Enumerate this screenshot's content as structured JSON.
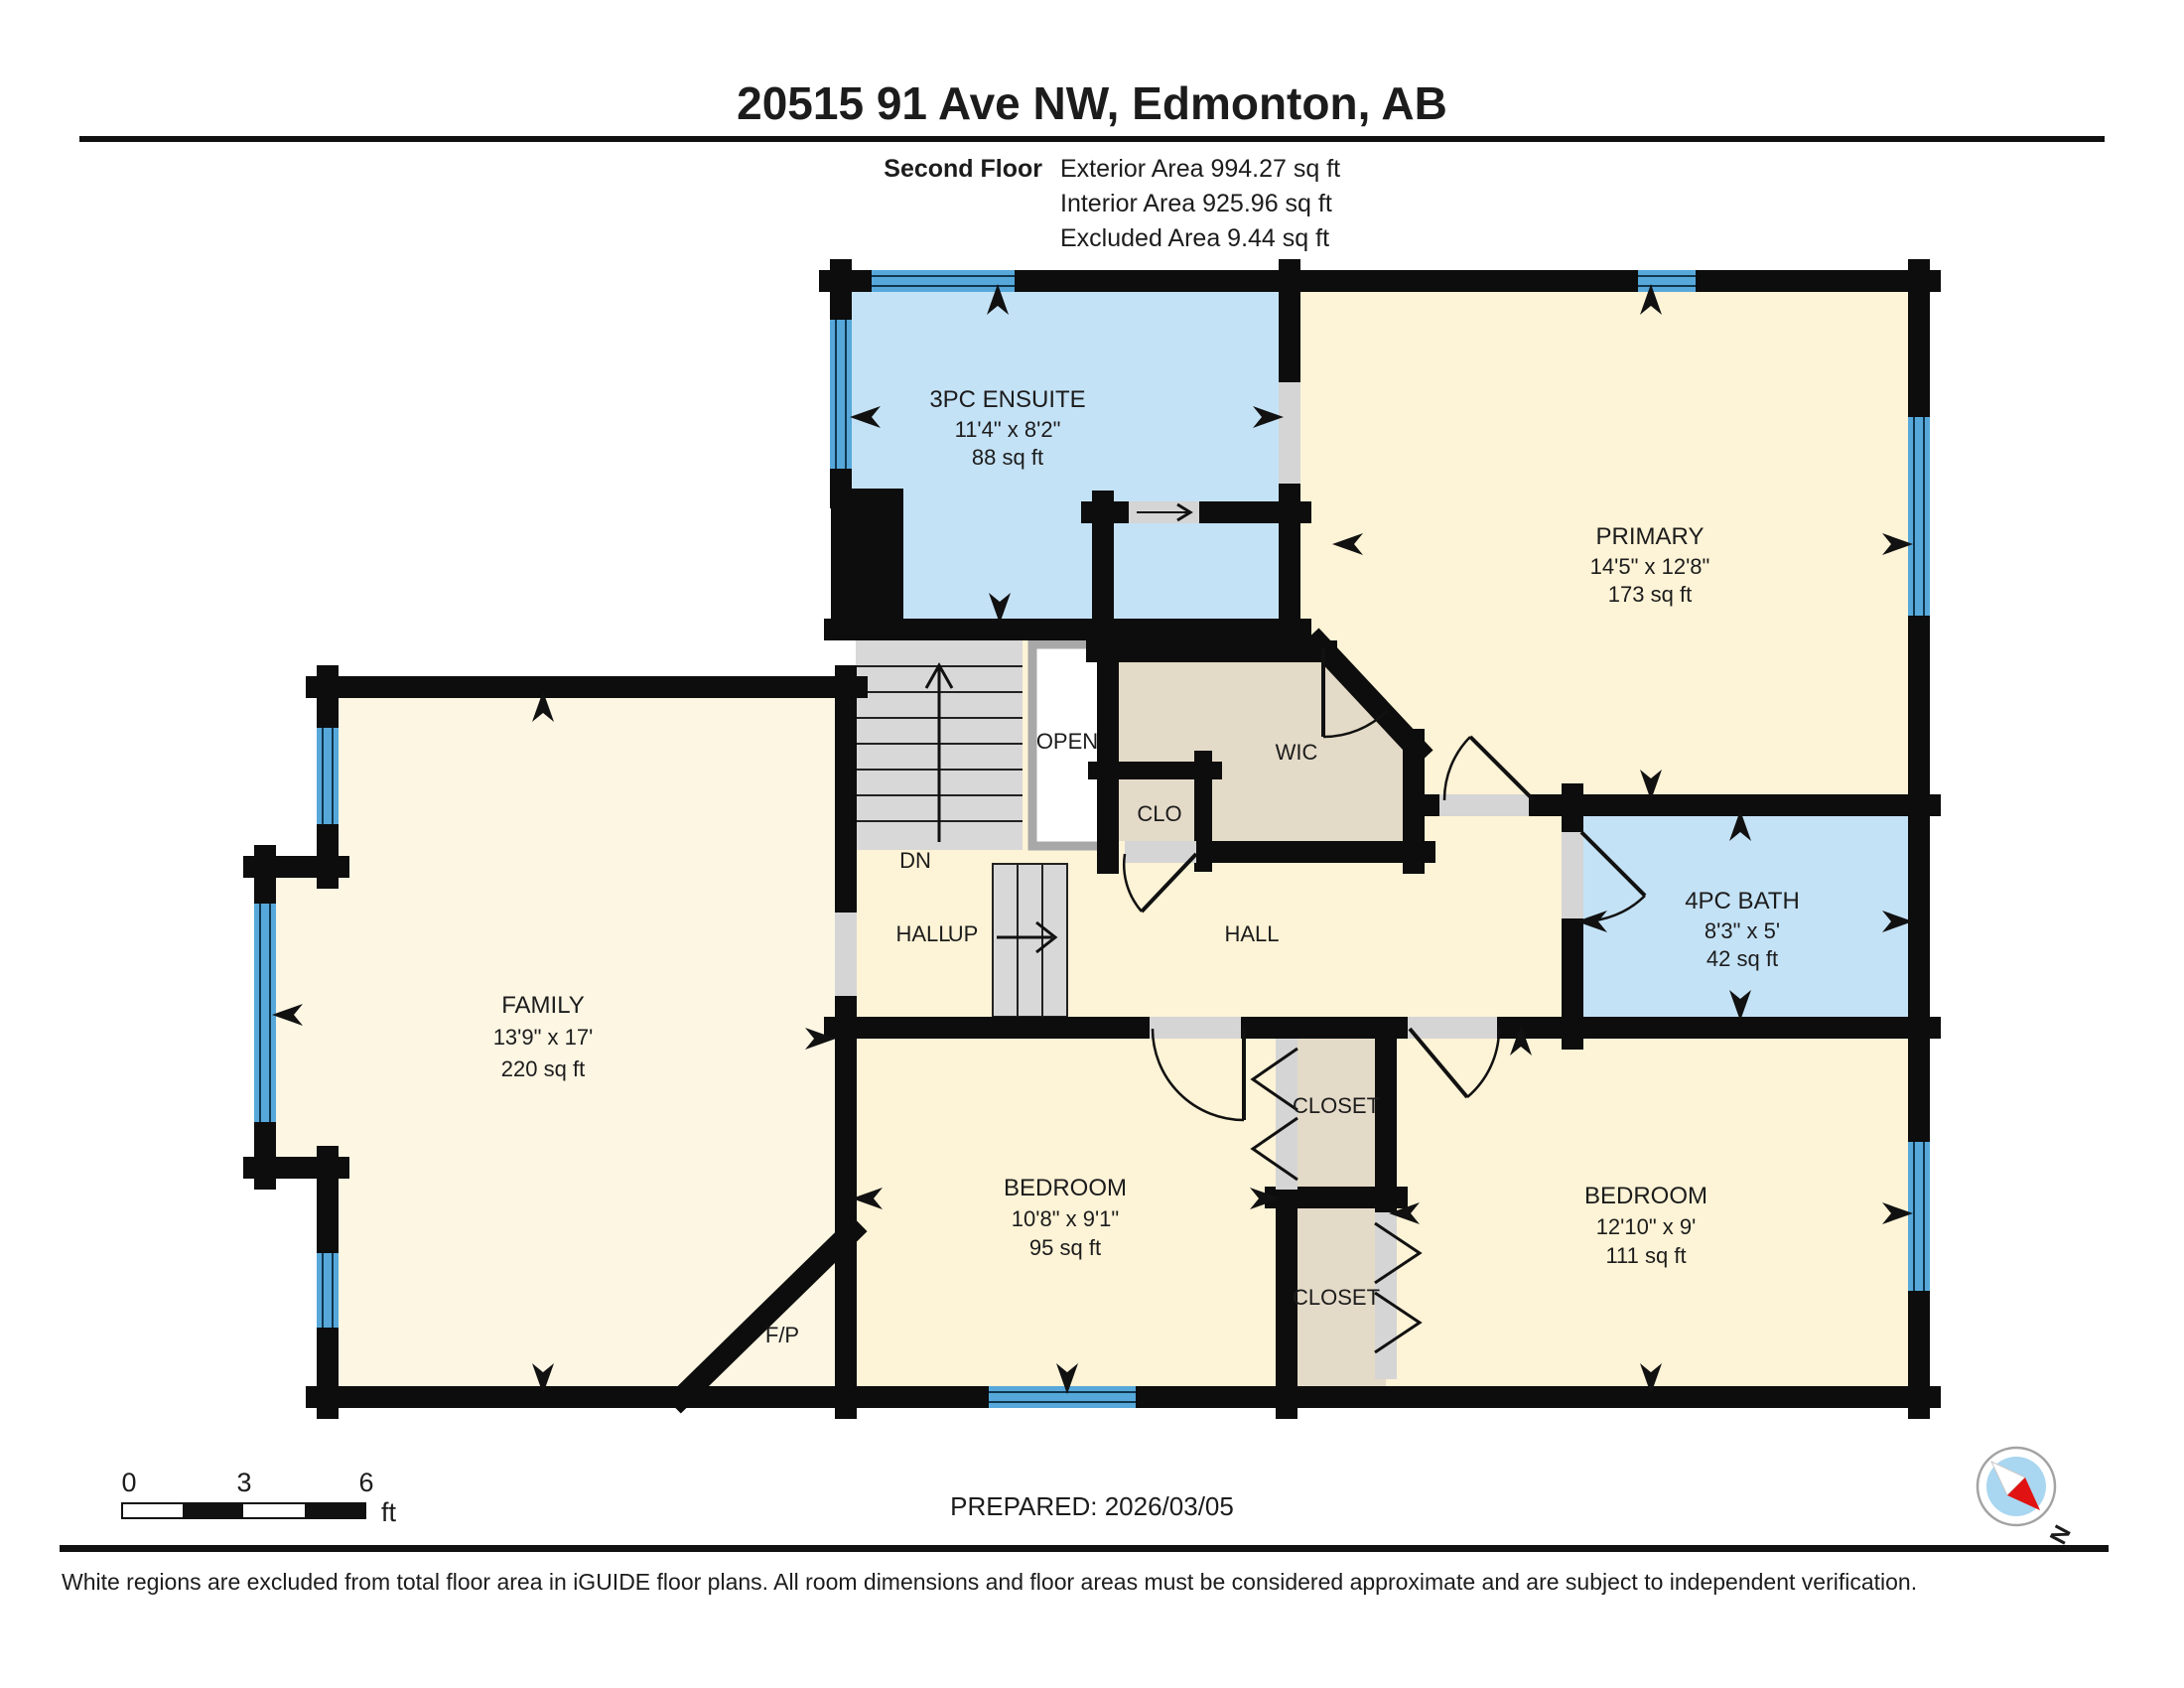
{
  "header": {
    "title": "20515 91 Ave NW, Edmonton, AB",
    "floor_label": "Second Floor",
    "exterior_area": "Exterior Area 994.27 sq ft",
    "interior_area": "Interior Area 925.96 sq ft",
    "excluded_area": "Excluded Area 9.44 sq ft"
  },
  "rooms": {
    "ensuite": {
      "name": "3PC ENSUITE",
      "dims": "11'4\" x 8'2\"",
      "area": "88 sq ft"
    },
    "primary": {
      "name": "PRIMARY",
      "dims": "14'5\" x 12'8\"",
      "area": "173 sq ft"
    },
    "bath": {
      "name": "4PC BATH",
      "dims": "8'3\" x 5'",
      "area": "42 sq ft"
    },
    "family": {
      "name": "FAMILY",
      "dims": "13'9\" x 17'",
      "area": "220 sq ft"
    },
    "bedroom1": {
      "name": "BEDROOM",
      "dims": "10'8\" x 9'1\"",
      "area": "95 sq ft"
    },
    "bedroom2": {
      "name": "BEDROOM",
      "dims": "12'10\" x 9'",
      "area": "111 sq ft"
    },
    "wic": "WIC",
    "clo": "CLO",
    "open": "OPEN",
    "closet1": "CLOSET",
    "closet2": "CLOSET",
    "fireplace": "F/P",
    "hall_left": "HALL",
    "hall_right": "HALL",
    "dn": "DN",
    "up": "UP"
  },
  "scale_bar": {
    "t0": "0",
    "t3": "3",
    "t6": "6",
    "unit": "ft"
  },
  "footer": {
    "prepared": "PREPARED: 2026/03/05",
    "compass_n": "N",
    "disclaimer": "White regions are excluded from total floor area in iGUIDE floor plans. All room dimensions and floor areas must be considered approximate and are subject to independent verification."
  },
  "colors": {
    "wall": "#0d0d0d",
    "cream": "#fdf3d6",
    "family_cream": "#fcf6e3",
    "wet_blue": "#c4e2f6",
    "tan": "#e4dac8",
    "window_blue": "#57a8da",
    "stair_gray": "#d8d8d8",
    "open_gray": "#d5d5d5",
    "ink": "#1c1c1c"
  }
}
